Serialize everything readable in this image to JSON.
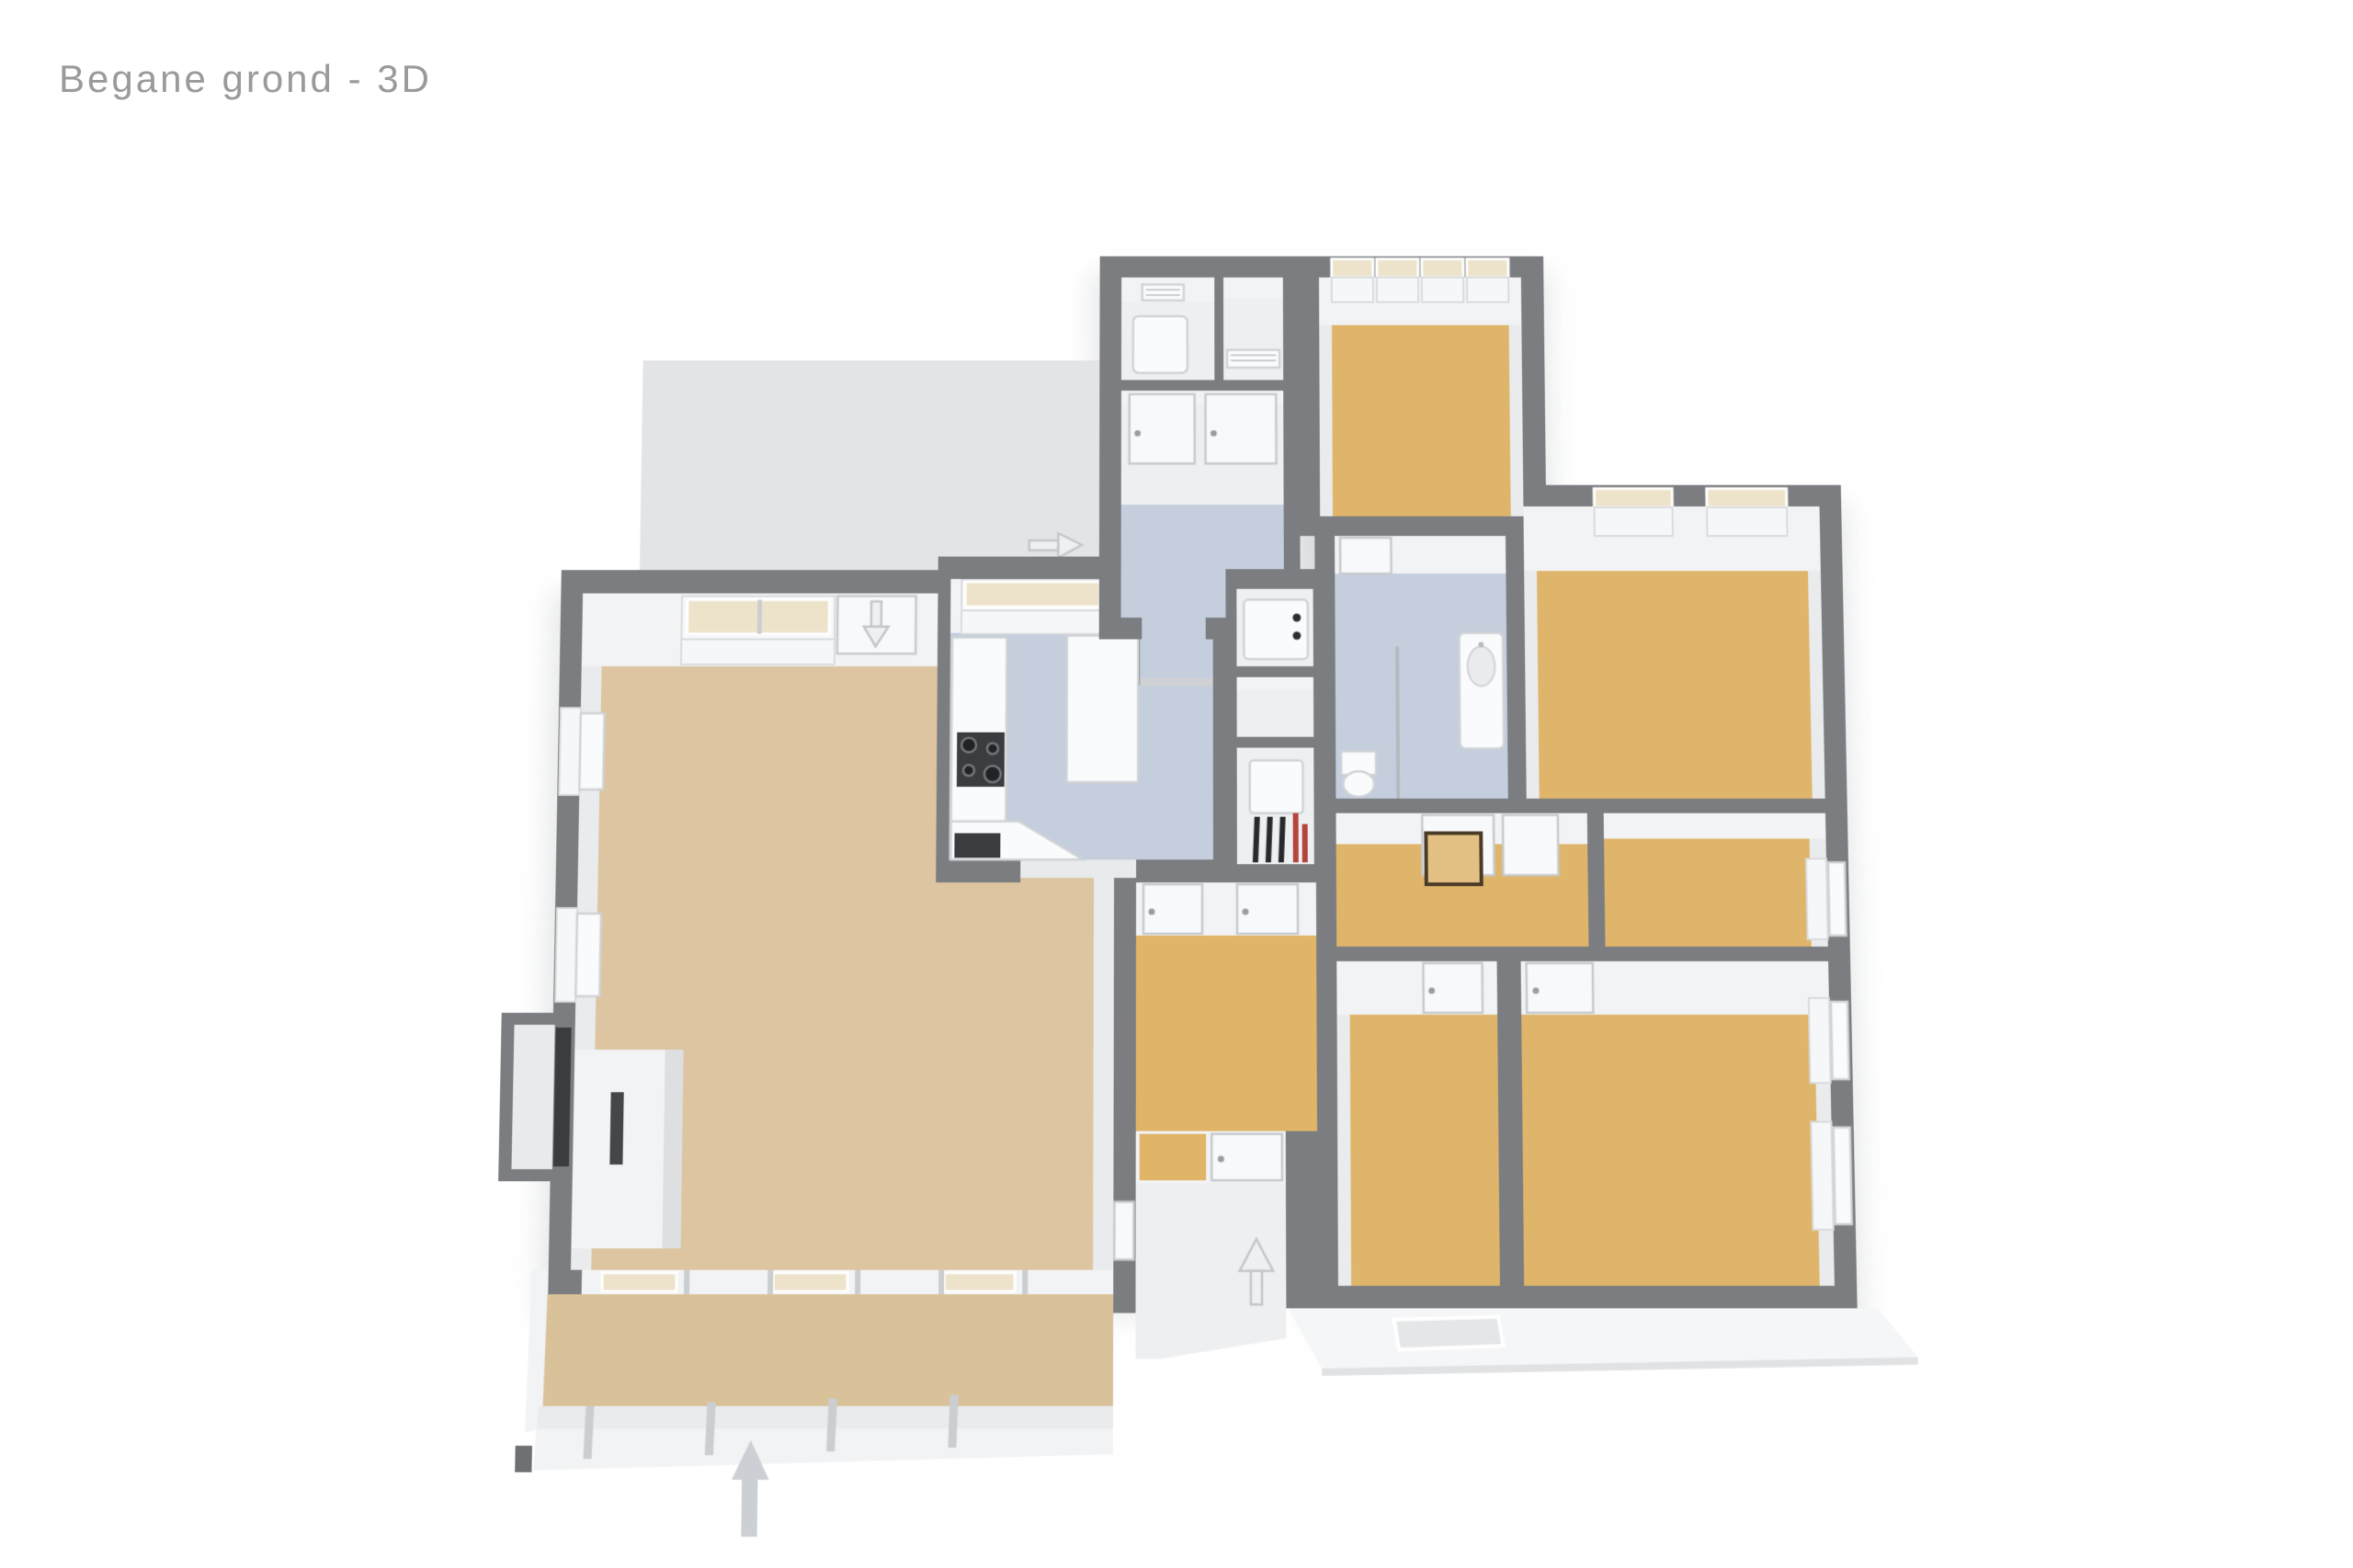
{
  "page": {
    "title": "Begane grond - 3D"
  },
  "colors": {
    "title": "#9a9a9a",
    "wall": "#7b7d80",
    "wall-dark": "#6e7073",
    "floor-tan": "#dfb56b",
    "floor-tan-light": "#dcc5a0",
    "floor-cons": "#d9c29a",
    "floor-hall": "#e0b568",
    "floor-blue": "#c4cedd",
    "floor-white": "#edeff1",
    "band": "#f2f3f5",
    "band-side": "#e9ebed",
    "patio": "#e3e4e6",
    "glass": "#ede3cb",
    "stoop": "#f5f6f8",
    "mat": "#e4e6e8",
    "arrow": "#ccd0d4",
    "dark": "#3a3c3f",
    "pipe-dark": "#27292c",
    "accent-red": "#b5443b"
  },
  "plan": {
    "type": "3d-floorplan",
    "floor_label": "Begane grond",
    "view": "3D",
    "rooms": [
      {
        "id": "patio-terrace",
        "floor": "#e3e4e6"
      },
      {
        "id": "living-room",
        "floor": "#dcc5a0"
      },
      {
        "id": "kitchen",
        "floor": "#c4cedd"
      },
      {
        "id": "back-vestibule",
        "floor": "#c4cedd"
      },
      {
        "id": "storage-left",
        "floor": "#edeff1"
      },
      {
        "id": "storage-right",
        "floor": "#edeff1"
      },
      {
        "id": "back-hall",
        "floor": "#c4cedd"
      },
      {
        "id": "bedroom-top",
        "floor": "#dfb56b"
      },
      {
        "id": "bathroom",
        "floor": "#c4cedd"
      },
      {
        "id": "utility-washer",
        "floor": "#edeff1"
      },
      {
        "id": "utility-middle",
        "floor": "#edeff1"
      },
      {
        "id": "utility-boiler",
        "floor": "#edeff1"
      },
      {
        "id": "bedroom-right-top",
        "floor": "#dfb56b"
      },
      {
        "id": "hall-with-hatch",
        "floor": "#dfb56b"
      },
      {
        "id": "bedroom-right-middle",
        "floor": "#dfb56b"
      },
      {
        "id": "bedroom-bottom-left",
        "floor": "#dfb56b"
      },
      {
        "id": "bedroom-bottom-right",
        "floor": "#dfb56b"
      },
      {
        "id": "hallway",
        "floor": "#e0b568"
      },
      {
        "id": "entry-porch",
        "floor": "#edeff1"
      },
      {
        "id": "conservatory",
        "floor": "#d9c29a"
      }
    ],
    "fixtures": [
      "stove-icon",
      "kitchen-island",
      "kitchen-counter",
      "microwave-icon",
      "sink-icon",
      "toilet-icon",
      "shower-screen",
      "washing-machine-icon",
      "boiler-icon",
      "fireplace",
      "floor-hatch",
      "doormat",
      "wall-shelf",
      "storage-box",
      "paper-ledge"
    ],
    "arrows": [
      {
        "id": "terrace-entrance-arrow",
        "direction": "right"
      },
      {
        "id": "living-terrace-arrow",
        "direction": "down"
      },
      {
        "id": "front-entrance-arrow",
        "direction": "up"
      },
      {
        "id": "plan-orientation-arrow",
        "direction": "up"
      }
    ]
  }
}
